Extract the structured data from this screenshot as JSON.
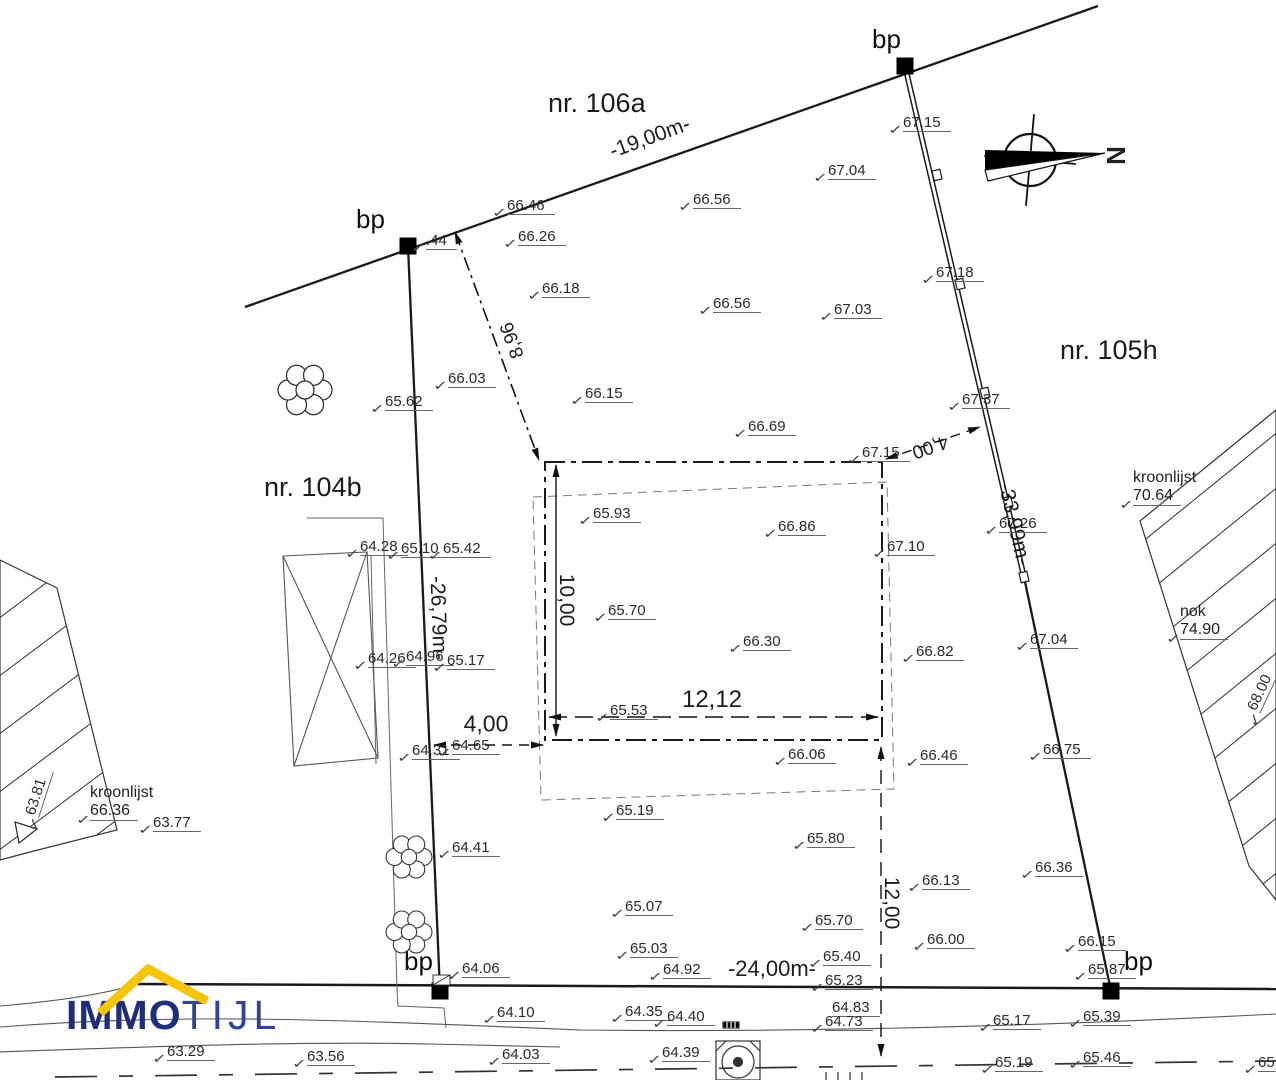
{
  "colors": {
    "line": "#1a1a1a",
    "logo_immo": "#1f2e78",
    "logo_tijl": "#31429a",
    "roof": "#f6c40b"
  },
  "bp_label": "bp",
  "north_label": "N",
  "logo": {
    "part1": "IMMO",
    "part2": "TIJL"
  },
  "parcels": [
    {
      "x": 548,
      "y": 88,
      "v": "nr. 106a"
    },
    {
      "x": 1060,
      "y": 335,
      "v": "nr. 105h"
    },
    {
      "x": 264,
      "y": 472,
      "v": "nr. 104b"
    }
  ],
  "bp_markers": [
    {
      "lx": 356,
      "ly": 204
    },
    {
      "lx": 872,
      "ly": 24
    },
    {
      "lx": 404,
      "ly": 946
    },
    {
      "lx": 1124,
      "ly": 946
    }
  ],
  "dimensions": [
    {
      "v": "-19,00m-",
      "x": 650,
      "y": 138,
      "r": -20,
      "s": 21
    },
    {
      "v": "8,96",
      "x": 513,
      "y": 340,
      "r": -110,
      "s": 19
    },
    {
      "v": "-26,79m-",
      "x": 438,
      "y": 618,
      "r": 88,
      "s": 21
    },
    {
      "v": "-33,99m-",
      "x": 1014,
      "y": 524,
      "r": 77,
      "s": 21
    },
    {
      "v": "4,00",
      "x": 930,
      "y": 446,
      "r": 161,
      "s": 19
    },
    {
      "v": "10,00",
      "x": 566,
      "y": 600,
      "r": 90,
      "s": 21
    },
    {
      "v": "12,12",
      "x": 712,
      "y": 700,
      "r": 0,
      "s": 24
    },
    {
      "v": "4,00",
      "x": 486,
      "y": 724,
      "r": 0,
      "s": 23
    },
    {
      "v": "12,00",
      "x": 891,
      "y": 903,
      "r": 90,
      "s": 21
    },
    {
      "v": "-24,00m-",
      "x": 772,
      "y": 969,
      "r": 0,
      "s": 22
    }
  ],
  "spots": [
    {
      "x": 507,
      "y": 197,
      "v": "66.46"
    },
    {
      "x": 518,
      "y": 228,
      "v": "66.26"
    },
    {
      "x": 693,
      "y": 191,
      "v": "66.56"
    },
    {
      "x": 828,
      "y": 162,
      "v": "67.04"
    },
    {
      "x": 903,
      "y": 114,
      "v": "67.15"
    },
    {
      "x": 542,
      "y": 280,
      "v": "66.18"
    },
    {
      "x": 713,
      "y": 295,
      "v": "66.56"
    },
    {
      "x": 834,
      "y": 301,
      "v": "67.03"
    },
    {
      "x": 936,
      "y": 264,
      "v": "67.18"
    },
    {
      "x": 448,
      "y": 370,
      "v": "66.03"
    },
    {
      "x": 385,
      "y": 393,
      "v": "65.62"
    },
    {
      "x": 585,
      "y": 385,
      "v": "66.15"
    },
    {
      "x": 748,
      "y": 418,
      "v": "66.69"
    },
    {
      "x": 862,
      "y": 444,
      "v": "67.15"
    },
    {
      "x": 962,
      "y": 391,
      "v": "67.37"
    },
    {
      "x": 999,
      "y": 515,
      "v": "67.26"
    },
    {
      "x": 593,
      "y": 505,
      "v": "65.93"
    },
    {
      "x": 778,
      "y": 518,
      "v": "66.86"
    },
    {
      "x": 887,
      "y": 538,
      "v": "67.10"
    },
    {
      "x": 360,
      "y": 538,
      "v": "64.28"
    },
    {
      "x": 401,
      "y": 540,
      "v": "65.10"
    },
    {
      "x": 443,
      "y": 540,
      "v": "65.42"
    },
    {
      "x": 608,
      "y": 602,
      "v": "65.70"
    },
    {
      "x": 743,
      "y": 633,
      "v": "66.30"
    },
    {
      "x": 916,
      "y": 643,
      "v": "66.82"
    },
    {
      "x": 1030,
      "y": 631,
      "v": "67.04"
    },
    {
      "x": 368,
      "y": 650,
      "v": "64.26"
    },
    {
      "x": 406,
      "y": 648,
      "v": "64.96"
    },
    {
      "x": 447,
      "y": 652,
      "v": "65.17"
    },
    {
      "x": 610,
      "y": 702,
      "v": "65.53"
    },
    {
      "x": 788,
      "y": 746,
      "v": "66.06"
    },
    {
      "x": 920,
      "y": 747,
      "v": "66.46"
    },
    {
      "x": 1043,
      "y": 741,
      "v": "66.75"
    },
    {
      "x": 412,
      "y": 742,
      "v": "64.31"
    },
    {
      "x": 452,
      "y": 737,
      "v": "64.65"
    },
    {
      "x": 616,
      "y": 802,
      "v": "65.19"
    },
    {
      "x": 452,
      "y": 839,
      "v": "64.41"
    },
    {
      "x": 807,
      "y": 830,
      "v": "65.80"
    },
    {
      "x": 922,
      "y": 872,
      "v": "66.13"
    },
    {
      "x": 1035,
      "y": 859,
      "v": "66.36"
    },
    {
      "x": 625,
      "y": 898,
      "v": "65.07"
    },
    {
      "x": 815,
      "y": 912,
      "v": "65.70"
    },
    {
      "x": 927,
      "y": 931,
      "v": "66.00"
    },
    {
      "x": 1078,
      "y": 933,
      "v": "66.15"
    },
    {
      "x": 630,
      "y": 940,
      "v": "65.03"
    },
    {
      "x": 663,
      "y": 961,
      "v": "64.92"
    },
    {
      "x": 823,
      "y": 948,
      "v": "65.40"
    },
    {
      "x": 825,
      "y": 972,
      "v": "65.23"
    },
    {
      "x": 462,
      "y": 960,
      "v": "64.06"
    },
    {
      "x": 1088,
      "y": 961,
      "v": "65.87"
    },
    {
      "x": 497,
      "y": 1004,
      "v": "64.10"
    },
    {
      "x": 625,
      "y": 1003,
      "v": "64.35"
    },
    {
      "x": 667,
      "y": 1008,
      "v": "64.40"
    },
    {
      "x": 832,
      "y": 999,
      "v": "64.83",
      "chk": 0
    },
    {
      "x": 825,
      "y": 1013,
      "v": "64.73"
    },
    {
      "x": 993,
      "y": 1012,
      "v": "65.17"
    },
    {
      "x": 1083,
      "y": 1008,
      "v": "65.39"
    },
    {
      "x": 167,
      "y": 1043,
      "v": "63.29"
    },
    {
      "x": 307,
      "y": 1048,
      "v": "63.56"
    },
    {
      "x": 502,
      "y": 1046,
      "v": "64.03"
    },
    {
      "x": 662,
      "y": 1044,
      "v": "64.39"
    },
    {
      "x": 995,
      "y": 1054,
      "v": "65.19"
    },
    {
      "x": 1083,
      "y": 1049,
      "v": "65.46"
    },
    {
      "x": 1258,
      "y": 1054,
      "v": "65.8"
    },
    {
      "x": 153,
      "y": 814,
      "v": "63.77"
    },
    {
      "x": 426,
      "y": 232,
      "v": ".44"
    },
    {
      "x": 22,
      "y": 812,
      "v": "63.81",
      "r": -72
    },
    {
      "x": 1244,
      "y": 706,
      "v": "68.00",
      "r": -65
    }
  ],
  "note_blocks": [
    {
      "x": 90,
      "y": 784,
      "l1": "kroonlijst",
      "l2": "66.36"
    },
    {
      "x": 1133,
      "y": 469,
      "l1": "kroonlijst",
      "l2": "70.64"
    },
    {
      "x": 1180,
      "y": 603,
      "l1": "nok",
      "l2": "74.90"
    }
  ]
}
